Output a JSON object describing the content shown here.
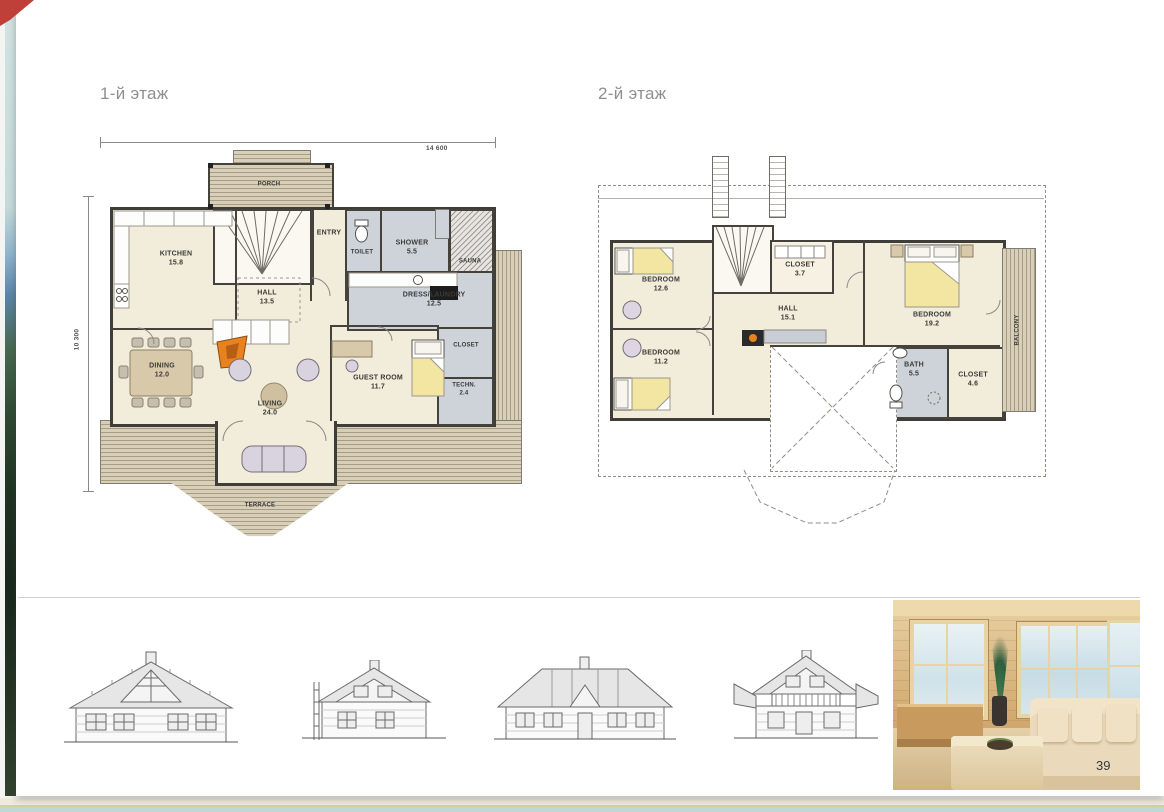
{
  "page": {
    "number": "39",
    "titles": {
      "floor1": "1-й этаж",
      "floor2": "2-й этаж"
    }
  },
  "floor1": {
    "dim_width": "14 600",
    "dim_height": "10 300",
    "rooms": {
      "porch": {
        "name": "PORCH"
      },
      "entry": {
        "name": "ENTRY"
      },
      "toilet": {
        "name": "TOILET"
      },
      "shower": {
        "name": "SHOWER",
        "area": "5.5"
      },
      "sauna": {
        "name": "SAUNA"
      },
      "kitchen": {
        "name": "KITCHEN",
        "area": "15.8"
      },
      "hall": {
        "name": "HALL",
        "area": "13.5"
      },
      "dress": {
        "name": "DRESS/LAUNDRY",
        "area": "12.5"
      },
      "closet": {
        "name": "CLOSET"
      },
      "guest": {
        "name": "GUEST ROOM",
        "area": "11.7"
      },
      "techn": {
        "name": "TECHN.",
        "area": "2.4"
      },
      "dining": {
        "name": "DINING",
        "area": "12.0"
      },
      "living": {
        "name": "LIVING",
        "area": "24.0"
      },
      "terrace": {
        "name": "TERRACE"
      }
    }
  },
  "floor2": {
    "rooms": {
      "bedroom1": {
        "name": "BEDROOM",
        "area": "12.6"
      },
      "bedroom2": {
        "name": "BEDROOM",
        "area": "11.2"
      },
      "hall": {
        "name": "HALL",
        "area": "15.1"
      },
      "closet1": {
        "name": "CLOSET",
        "area": "3.7"
      },
      "bedroom3": {
        "name": "BEDROOM",
        "area": "19.2"
      },
      "bath": {
        "name": "BATH",
        "area": "5.5"
      },
      "closet2": {
        "name": "CLOSET",
        "area": "4.6"
      },
      "balcony": {
        "name": "BALCONY"
      }
    }
  },
  "colors": {
    "room_fill": "#f2ecda",
    "wet_fill": "#cdd3d9",
    "deck_stripe": "#a89d81",
    "wall": "#45423c",
    "fireplace_orange": "#e8821f",
    "bed_yellow": "#f3e6a2",
    "page_edge_teal": "#bcd9d5"
  }
}
